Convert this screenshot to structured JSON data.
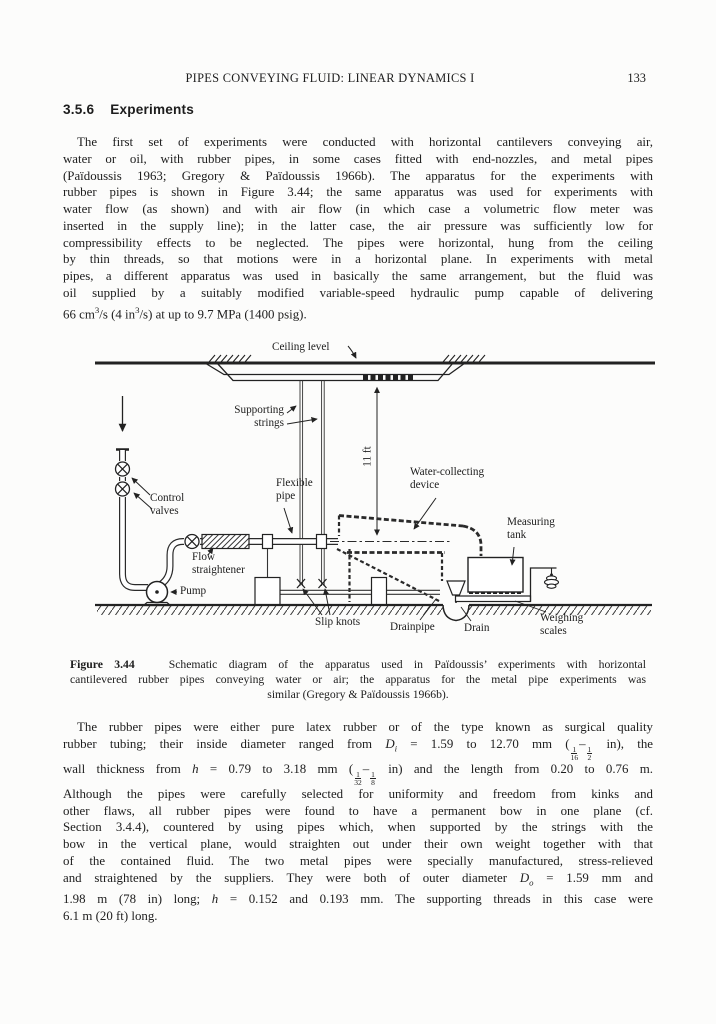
{
  "header": {
    "title": "PIPES CONVEYING FLUID: LINEAR DYNAMICS I",
    "page_number": "133"
  },
  "section": {
    "number": "3.5.6",
    "title": "Experiments"
  },
  "paragraph1": {
    "lines": [
      "The first set of experiments were conducted with horizontal cantilevers conveying air,",
      "water or oil, with rubber pipes, in some cases fitted with end-nozzles, and metal pipes",
      "(Païdoussis 1963; Gregory & Païdoussis 1966b). The apparatus for the experiments with",
      "rubber pipes is shown in Figure 3.44; the same apparatus was used for experiments with",
      "water flow (as shown) and with air flow (in which case a volumetric flow meter was",
      "inserted in the supply line); in the latter case, the air pressure was sufficiently low for",
      "compressibility effects to be neglected. The pipes were horizontal, hung from the ceiling",
      "by thin threads, so that motions were in a horizontal plane. In experiments with metal",
      "pipes, a different apparatus was used in basically the same arrangement, but the fluid was",
      "oil supplied by a suitably modified variable-speed hydraulic pump capable of delivering",
      "66 cm<sup>3</sup>/s (4 in<sup>3</sup>/s) at up to 9.7 MPa (1400 psig)."
    ]
  },
  "figure": {
    "labels": {
      "ceiling_level": "Ceiling level",
      "supporting_strings": [
        "Supporting",
        "strings"
      ],
      "control_valves": [
        "Control",
        "valves"
      ],
      "flexible_pipe": [
        "Flexible",
        "pipe"
      ],
      "flow_straightener": [
        "Flow",
        "straightener"
      ],
      "pump": "Pump",
      "water_collecting": [
        "Water-collecting",
        "device"
      ],
      "measuring_tank": [
        "Measuring",
        "tank"
      ],
      "slip_knots": "Slip knots",
      "drainpipe": "Drainpipe",
      "drain": "Drain",
      "weighing_scales": [
        "Weighing",
        "scales"
      ],
      "dimension": "11 ft"
    },
    "caption": {
      "lines": [
        "<b>Figure 3.44</b>&nbsp;&nbsp; Schematic diagram of the apparatus used in Païdoussis’ experiments with horizontal",
        "cantilevered rubber pipes conveying water or air; the apparatus for the metal pipe experiments was",
        "similar (Gregory & Païdoussis 1966b)."
      ]
    }
  },
  "paragraph2": {
    "lines": [
      "The rubber pipes were either pure latex rubber or of the type known as surgical quality",
      "rubber tubing; their inside diameter ranged from <i>D<sub>i</sub></i> = 1.59 to 12.70 mm (<span class='fr'><span class='nu'>1</span><span class='de'>16</span></span>–<span class='fr'><span class='nu'>1</span><span class='de'>2</span></span> in), the",
      "wall thickness from <i>h</i> = 0.79 to 3.18 mm (<span class='fr'><span class='nu'>1</span><span class='de'>32</span></span>–<span class='fr'><span class='nu'>1</span><span class='de'>8</span></span> in) and the length from 0.20 to 0.76 m.",
      "Although the pipes were carefully selected for uniformity and freedom from kinks and",
      "other flaws, all rubber pipes were found to have a permanent bow in one plane (cf.",
      "Section 3.4.4), countered by using pipes which, when supported by the strings with the",
      "bow in the vertical plane, would straighten out under their own weight together with that",
      "of the contained fluid. The two metal pipes were specially manufactured, stress-relieved",
      "and straightened by the suppliers. They were both of outer diameter <i>D<sub>o</sub></i> = 1.59 mm and",
      "1.98 m (78 in) long; <i>h</i> = 0.152 and 0.193 mm. The supporting threads in this case were",
      "6.1 m (20 ft) long."
    ]
  }
}
